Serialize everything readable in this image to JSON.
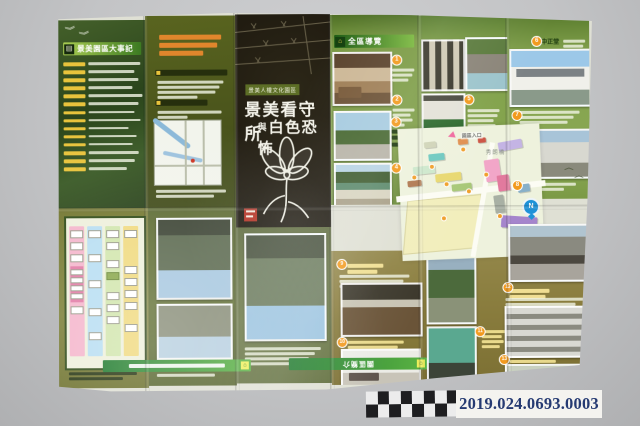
{
  "catalog": {
    "number": "2019.024.0693.0003"
  },
  "brochure": {
    "timeline_title": "景美園區大事記",
    "cover": {
      "series_label": "景美人權文化園區",
      "title_main": "景美看守所",
      "title_conj": "與",
      "title_sub": "白色恐怖"
    },
    "tour_banner": "全區導覽",
    "site_labels": {
      "entrance": "園區入口",
      "bridge": "秀朗橋",
      "compass": "N"
    },
    "poi_numbers": [
      "1",
      "2",
      "3",
      "4",
      "5",
      "6",
      "7",
      "8",
      "9",
      "10",
      "11",
      "12",
      "13"
    ],
    "poi_item_6_label": "中正堂",
    "back_banner_label": "園區簡介",
    "accent_colors": {
      "page_green": "#7f9d45",
      "khaki_gold": "#8a7d3a",
      "cover_black": "#201c12",
      "marker_orange": "#f29a1e",
      "date_yellow": "#e8c33c"
    }
  }
}
